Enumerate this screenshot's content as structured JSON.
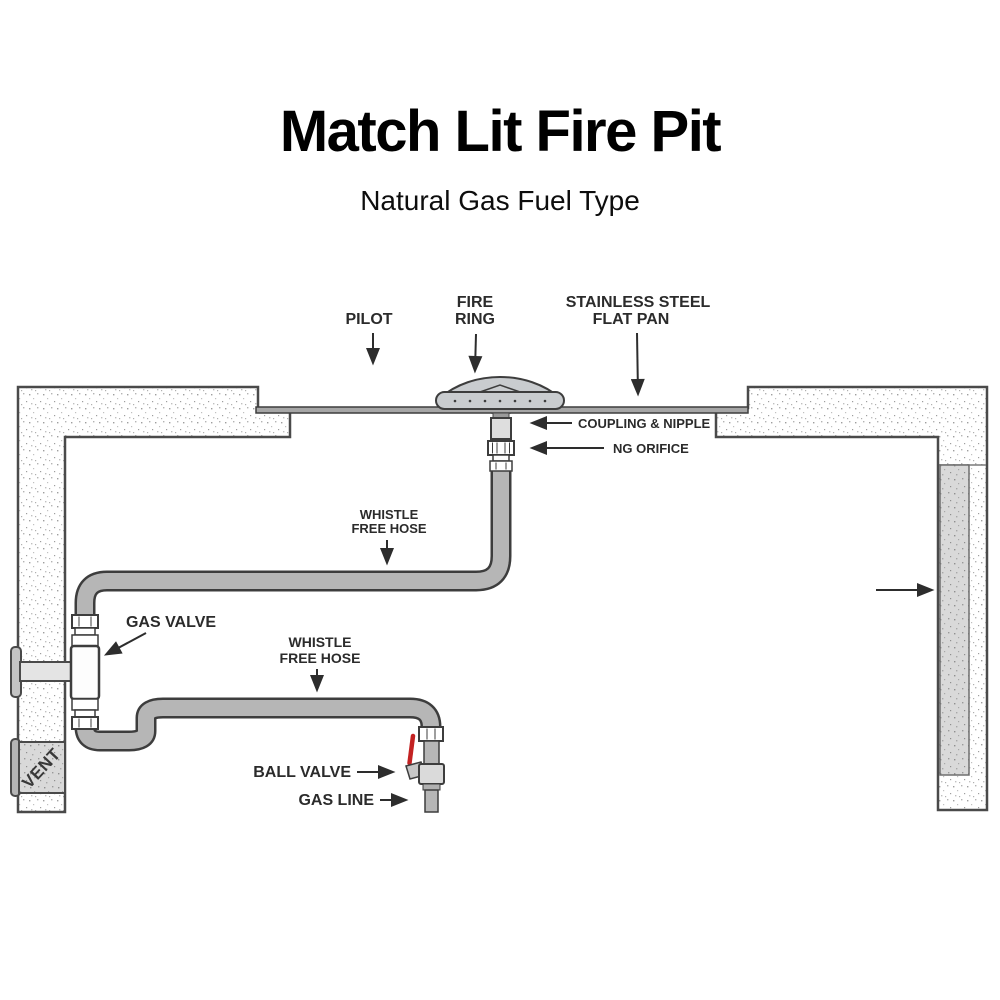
{
  "header": {
    "title": "Match Lit Fire Pit",
    "subtitle": "Natural Gas Fuel Type"
  },
  "labels": {
    "pilot": "PILOT",
    "fire_ring": {
      "line1": "FIRE",
      "line2": "RING"
    },
    "flat_pan": {
      "line1": "STAINLESS STEEL",
      "line2": "FLAT PAN"
    },
    "coupling_nipple": "COUPLING & NIPPLE",
    "ng_orifice": "NG ORIFICE",
    "whistle_hose_upper": {
      "line1": "WHISTLE",
      "line2": "FREE HOSE"
    },
    "gas_valve": "GAS VALVE",
    "whistle_hose_lower": {
      "line1": "WHISTLE",
      "line2": "FREE HOSE"
    },
    "ball_valve": "BALL VALVE",
    "gas_line": "GAS LINE",
    "vent": "VENT"
  },
  "colors": {
    "label_text": "#2b2b2b",
    "outline": "#3d3d3d",
    "hose_fill": "#b6b6b6",
    "pan_fill": "#a6a6a6",
    "fire_ring_fill": "#c9cccf",
    "masonry_gray": "#d9d9d9",
    "ball_valve_lever_red": "#c32222"
  }
}
